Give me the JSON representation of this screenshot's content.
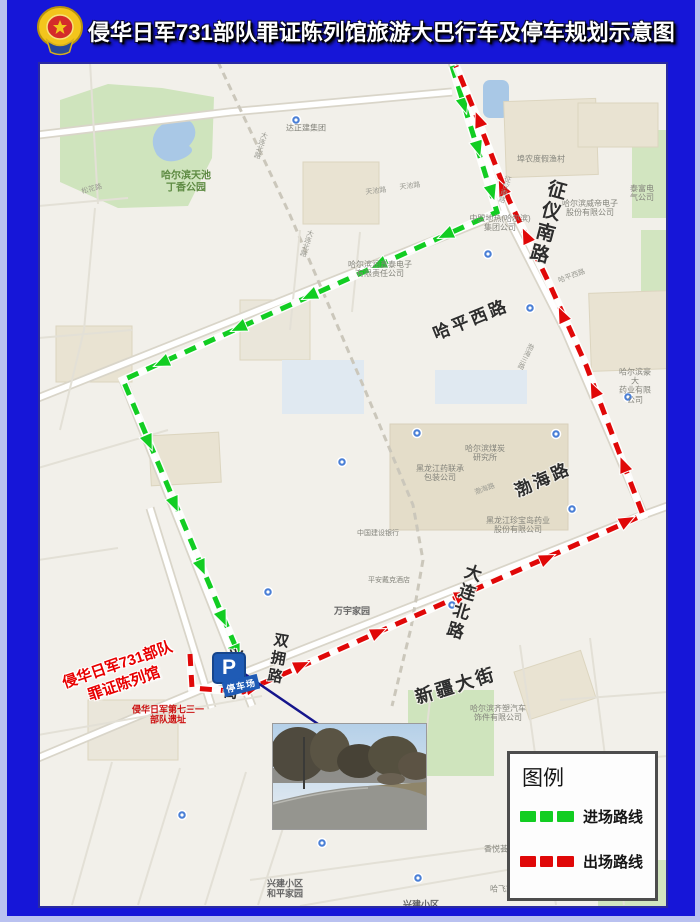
{
  "title_bar": {
    "title": "侵华日军731部队罪证陈列馆旅游大巴行车及停车规划示意图"
  },
  "legend": {
    "title": "图例",
    "items": [
      {
        "label": "进场路线",
        "color": "#12cd22"
      },
      {
        "label": "出场路线",
        "color": "#e00808"
      }
    ]
  },
  "parking": {
    "icon_letter": "P",
    "label": "停车场"
  },
  "destination_label": {
    "line1": "侵华日军731部队",
    "line2": "罪证陈列馆"
  },
  "colors": {
    "frame": "#1616d8",
    "frame_edge": "#b9c1f0",
    "entry_route": "#12cd22",
    "exit_route": "#e00808",
    "parking_blue": "#1f5bb5",
    "destination_red": "#e80000"
  },
  "routes": {
    "entry": {
      "name": "进场路线",
      "color": "#12cd22",
      "points": [
        [
          452,
          66
        ],
        [
          497,
          212
        ],
        [
          123,
          380
        ],
        [
          237,
          650
        ]
      ],
      "arrows": [
        [
          462,
          99,
          73
        ],
        [
          476,
          142,
          73
        ],
        [
          490,
          186,
          73
        ],
        [
          452,
          232,
          156
        ],
        [
          385,
          262,
          156
        ],
        [
          316,
          293,
          156
        ],
        [
          245,
          325,
          156
        ],
        [
          168,
          360,
          156
        ],
        [
          146,
          436,
          67
        ],
        [
          172,
          498,
          67
        ],
        [
          199,
          561,
          67
        ],
        [
          220,
          612,
          67
        ],
        [
          234,
          646,
          67
        ]
      ]
    },
    "exit": {
      "name": "出场路线",
      "color": "#e00808",
      "points": [
        [
          190,
          654
        ],
        [
          192,
          688
        ],
        [
          243,
          692
        ],
        [
          643,
          515
        ],
        [
          617,
          447
        ],
        [
          586,
          365
        ],
        [
          549,
          283
        ],
        [
          509,
          200
        ],
        [
          476,
          115
        ],
        [
          456,
          66
        ]
      ],
      "arrows": [
        [
          247,
          689,
          -14
        ],
        [
          295,
          668,
          -24
        ],
        [
          372,
          635,
          -24
        ],
        [
          456,
          598,
          -24
        ],
        [
          541,
          561,
          -24
        ],
        [
          621,
          524,
          -28
        ],
        [
          626,
          471,
          -112
        ],
        [
          597,
          396,
          -115
        ],
        [
          565,
          321,
          -115
        ],
        [
          529,
          242,
          -115
        ],
        [
          505,
          194,
          -115
        ],
        [
          481,
          126,
          -111
        ]
      ]
    }
  },
  "road_labels": [
    {
      "text": "征仪南路",
      "x": 508,
      "y": 160,
      "size": 19,
      "vertical": true,
      "rot": 15
    },
    {
      "text": "哈平西路",
      "x": 433,
      "y": 258,
      "size": 17,
      "rot": -22
    },
    {
      "text": "渤海路",
      "x": 505,
      "y": 418,
      "size": 17,
      "rot": -24
    },
    {
      "text": "大连北路",
      "x": 424,
      "y": 540,
      "size": 17,
      "vertical": true,
      "rot": 17
    },
    {
      "text": "新疆大街",
      "x": 418,
      "y": 624,
      "size": 18,
      "rot": -17
    },
    {
      "text": "兴建街",
      "x": 194,
      "y": 613,
      "size": 15,
      "vertical": true,
      "rot": 8
    },
    {
      "text": "双拥路",
      "x": 239,
      "y": 597,
      "size": 15,
      "vertical": true,
      "rot": 10
    }
  ],
  "map_labels": [
    {
      "text": "哈尔滨天池\n丁香公园",
      "x": 148,
      "y": 120,
      "size": 10,
      "color": "#5d8a42",
      "bold": true
    },
    {
      "text": "达正建集团",
      "x": 268,
      "y": 66,
      "size": 8
    },
    {
      "text": "埠农度假渔村",
      "x": 503,
      "y": 97,
      "size": 8
    },
    {
      "text": "泰富电气公司",
      "x": 604,
      "y": 131,
      "size": 8
    },
    {
      "text": "哈尔滨威帝电子\n股份有限公司",
      "x": 552,
      "y": 146,
      "size": 8
    },
    {
      "text": "中盟地热(哈尔滨)\n集团公司",
      "x": 462,
      "y": 161,
      "size": 8
    },
    {
      "text": "哈尔滨润鑫泰电子\n有限责任公司",
      "x": 342,
      "y": 207,
      "size": 8
    },
    {
      "text": "天池路",
      "x": 338,
      "y": 130,
      "size": 7,
      "rot": -7,
      "color": "#9a9a92"
    },
    {
      "text": "天池路",
      "x": 372,
      "y": 125,
      "size": 7,
      "rot": -7,
      "color": "#9a9a92"
    },
    {
      "text": "松花路",
      "x": 54,
      "y": 128,
      "size": 7,
      "rot": -15,
      "color": "#9a9a92"
    },
    {
      "text": "大连北路",
      "x": 222,
      "y": 83,
      "size": 7,
      "vertical": true,
      "rot": 18,
      "color": "#9a9a92"
    },
    {
      "text": "大连北路",
      "x": 268,
      "y": 181,
      "size": 7,
      "vertical": true,
      "rot": 18,
      "color": "#9a9a92"
    },
    {
      "text": "征仪南路",
      "x": 466,
      "y": 127,
      "size": 7,
      "vertical": true,
      "rot": 16,
      "color": "#9a9a92"
    },
    {
      "text": "哈平西路",
      "x": 534,
      "y": 215,
      "size": 7,
      "rot": -20,
      "color": "#9a9a92"
    },
    {
      "text": "哈尔滨煤炭\n研究所",
      "x": 447,
      "y": 391,
      "size": 8
    },
    {
      "text": "黑龙江药联承\n包装公司",
      "x": 402,
      "y": 411,
      "size": 8
    },
    {
      "text": "渤海路",
      "x": 447,
      "y": 428,
      "size": 7,
      "rot": -20,
      "color": "#9a9a92"
    },
    {
      "text": "黑龙江珍宝岛药业\n股份有限公司",
      "x": 480,
      "y": 463,
      "size": 8
    },
    {
      "text": "哈尔滨豪大\n药业有限公司",
      "x": 597,
      "y": 324,
      "size": 8
    },
    {
      "text": "渤海三路",
      "x": 487,
      "y": 294,
      "size": 7,
      "vertical": true,
      "rot": 25,
      "color": "#9a9a92"
    },
    {
      "text": "万宇家园",
      "x": 314,
      "y": 549,
      "size": 9,
      "bold": true,
      "color": "#666"
    },
    {
      "text": "中国建设银行",
      "x": 340,
      "y": 472,
      "size": 7
    },
    {
      "text": "平安戴克酒店",
      "x": 351,
      "y": 519,
      "size": 7
    },
    {
      "text": "哈尔滨齐塑汽车\n饰件有限公司",
      "x": 460,
      "y": 651,
      "size": 8
    },
    {
      "text": "香悦荟樾城",
      "x": 560,
      "y": 744,
      "size": 8
    },
    {
      "text": "香悦荟天下",
      "x": 466,
      "y": 787,
      "size": 8
    },
    {
      "text": "哈飞家园",
      "x": 468,
      "y": 827,
      "size": 8
    },
    {
      "text": "兴建小区\n和平家园",
      "x": 247,
      "y": 827,
      "size": 9,
      "bold": true,
      "color": "#666"
    },
    {
      "text": "兴建小区\n金宾家园",
      "x": 383,
      "y": 848,
      "size": 9,
      "bold": true,
      "color": "#666"
    },
    {
      "text": "兴建小区·B区",
      "x": 306,
      "y": 893,
      "size": 9,
      "bold": true,
      "color": "#666"
    },
    {
      "text": "侵华日军第七三一\n部队遗址",
      "x": 130,
      "y": 653,
      "size": 9,
      "bold": true,
      "color": "#cc1111"
    }
  ],
  "transit_stops": [
    [
      296,
      120
    ],
    [
      536,
      248
    ],
    [
      488,
      254
    ],
    [
      417,
      433
    ],
    [
      628,
      397
    ],
    [
      572,
      509
    ],
    [
      452,
      605
    ],
    [
      268,
      592
    ],
    [
      322,
      843
    ],
    [
      628,
      823
    ],
    [
      418,
      878
    ],
    [
      182,
      815
    ],
    [
      342,
      462
    ],
    [
      530,
      308
    ],
    [
      556,
      434
    ]
  ]
}
